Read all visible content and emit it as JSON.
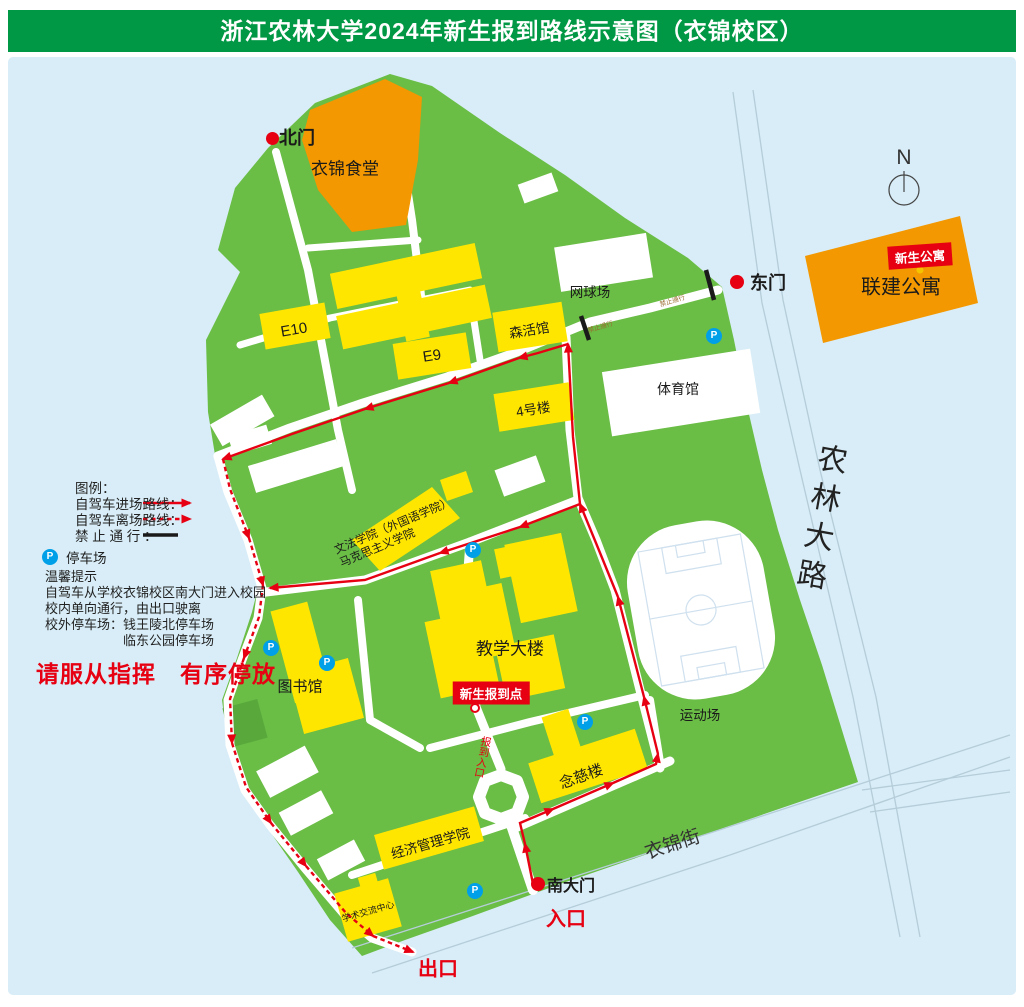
{
  "title": "浙江农林大学2024年新生报到路线示意图（衣锦校区）",
  "compass_n": "N",
  "legend": {
    "heading": "图例：",
    "arrive_label": "自驾车进场路线：",
    "depart_label": "自驾车离场路线：",
    "forbidden_label": "禁 止 通 行 ：",
    "parking_label": "停车场",
    "p_letter": "P"
  },
  "notice": {
    "heading": "温馨提示",
    "line1": "自驾车从学校衣锦校区南大门进入校园",
    "line2": "校内单向通行，由出口驶离",
    "line3": "校外停车场：钱王陵北停车场",
    "line3_cont": "临东公园停车场",
    "slogan": "请服从指挥　有序停放"
  },
  "gates": {
    "north": "北门",
    "east": "东门",
    "south": "南大门",
    "entrance": "入口",
    "exit": "出口"
  },
  "buildings": {
    "canteen": "衣锦食堂",
    "lianjian_apartment": "联建公寓",
    "freshman_apartment_tag": "新生公寓",
    "tennis_court": "网球场",
    "e10": "E10",
    "e9": "E9",
    "senhuo_hall": "森活馆",
    "building_4": "4号楼",
    "gymnasium": "体育馆",
    "wenfa_line1": "文法学院（外国语学院）",
    "wenfa_line2": "马克思主义学院",
    "teaching_building": "教学大楼",
    "checkin_point": "新生报到点",
    "checkin_entrance": "报到入口",
    "library": "图书馆",
    "sports_field": "运动场",
    "nianci_building": "念慈楼",
    "economics_school": "经济管理学院",
    "academic_center": "学术交流中心"
  },
  "streets": {
    "nonglin_road": "农林大路",
    "yijin_street": "衣锦街",
    "no_passing": "禁止通行"
  },
  "colors": {
    "header_green": "#009844",
    "campus_green": "#6abd45",
    "water_blue": "#d8edf7",
    "building_yellow": "#ffe600",
    "building_orange": "#f39800",
    "route_red": "#e60012",
    "parking_blue": "#00a0e9"
  }
}
